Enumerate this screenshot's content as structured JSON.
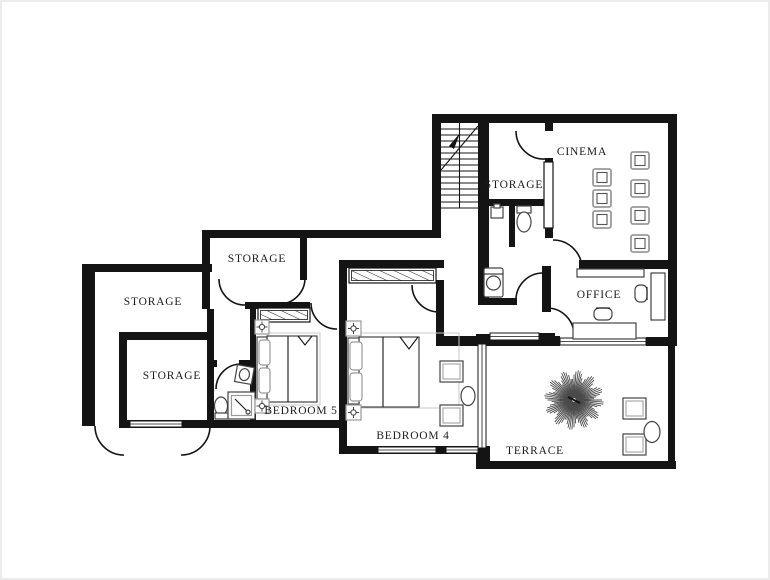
{
  "plan": {
    "title": "floor-plan",
    "rooms": [
      {
        "id": "cinema",
        "label": "CINEMA"
      },
      {
        "id": "storage-upper",
        "label": "STORAGE"
      },
      {
        "id": "office",
        "label": "OFFICE"
      },
      {
        "id": "terrace",
        "label": "TERRACE"
      },
      {
        "id": "bedroom-4",
        "label": "BEDROOM 4"
      },
      {
        "id": "bedroom-5",
        "label": "BEDROOM 5"
      },
      {
        "id": "storage-middle",
        "label": "STORAGE"
      },
      {
        "id": "storage-left",
        "label": "STORAGE"
      },
      {
        "id": "storage-bottom-left",
        "label": "STORAGE"
      }
    ],
    "colors": {
      "wall": "#141414",
      "label": "#1b1b1b",
      "furniture_dark": "#444444",
      "furniture_light": "#999999",
      "background": "#ffffff"
    }
  }
}
